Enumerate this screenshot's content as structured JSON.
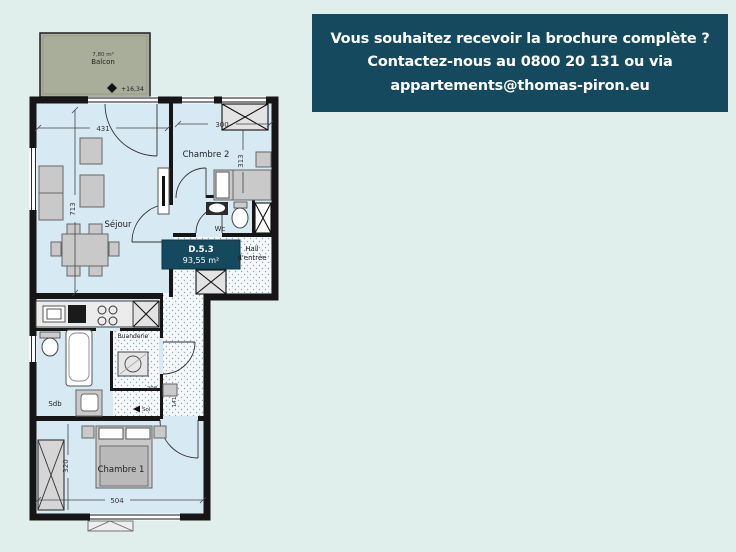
{
  "banner": {
    "line1": "Vous souhaitez recevoir la brochure complète ?",
    "line2": "Contactez-nous au 0800 20 131 ou via",
    "line3": "appartements@thomas-piron.eu",
    "bg_color": "#154a5e",
    "text_color": "#ffffff"
  },
  "plan": {
    "unit": {
      "code": "D.5.3",
      "area": "93,55 m²"
    },
    "balcony": {
      "area": "7,80 m²",
      "label": "Balcon",
      "level": "+16,34"
    },
    "rooms": {
      "sejour": "Séjour",
      "chambre2": "Chambre 2",
      "wc": "Wc",
      "hall_line1": "Hall",
      "hall_line2": "d'entrée",
      "buanderie": "Buanderie",
      "sdb": "Sdb",
      "chambre1": "Chambre 1"
    },
    "dimensions": {
      "sejour_width": "431",
      "sejour_height": "713",
      "chambre2_width": "300",
      "chambre2_height": "313",
      "chambre1_width": "504",
      "chambre1_height": "320",
      "hall_width": "208",
      "entry_depth": "141",
      "entry_note": "Sol"
    },
    "colors": {
      "floor": "#d7e9f3",
      "balcony_fill": "#a8ae9a",
      "wall": "#161616",
      "badge": "#154a5e"
    }
  }
}
